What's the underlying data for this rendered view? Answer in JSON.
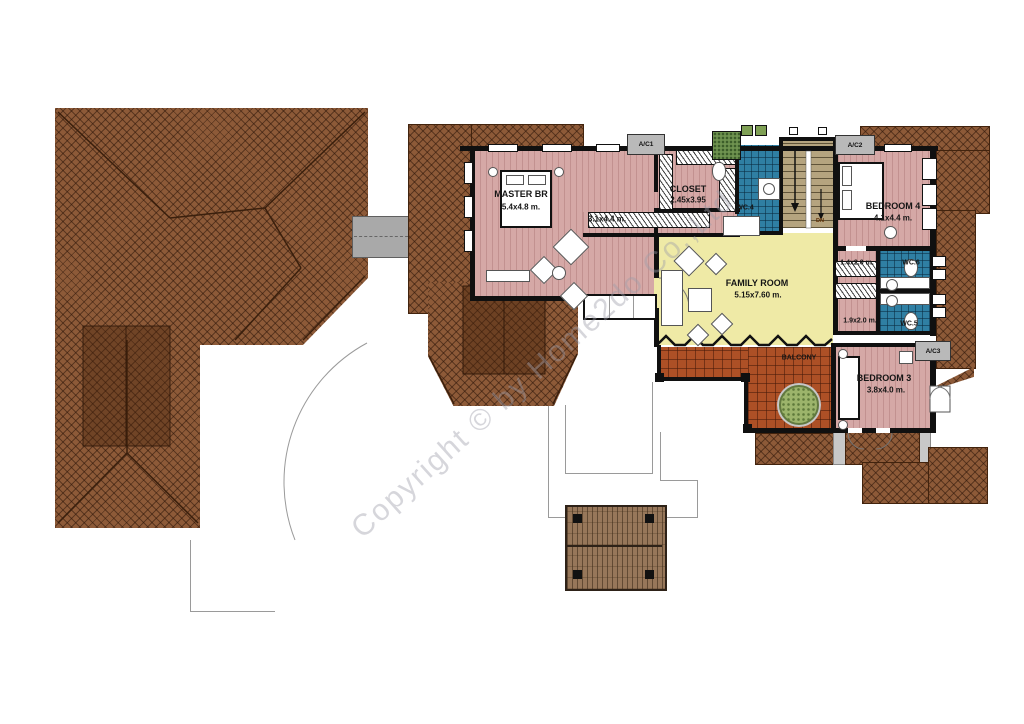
{
  "plan": {
    "type": "second-floor-plan",
    "watermark": "Copyright © by Home2do Co.,Ltd",
    "rooms": {
      "master": {
        "name": "MASTER BR",
        "dims": "5.4x4.8 m."
      },
      "sitting": {
        "dims": "3.1x4.4 m."
      },
      "closet": {
        "name": "CLOSET",
        "dims": "2.45x3.95"
      },
      "wc4": {
        "name": "WC.4"
      },
      "wc5": {
        "name": "WC.5"
      },
      "wc6": {
        "name": "WC.6"
      },
      "bedroom4": {
        "name": "BEDROOM 4",
        "dims": "4.1x4.4 m."
      },
      "bedroom3": {
        "name": "BEDROOM 3",
        "dims": "3.8x4.0 m."
      },
      "family": {
        "name": "FAMILY ROOM",
        "dims": "5.15x7.60 m."
      },
      "balcony": {
        "name": "BALCONY"
      },
      "dressing_top": {
        "dims": "1.4x2.0 m."
      },
      "dressing_bottom": {
        "dims": "1.9x2.0 m."
      }
    },
    "stairs": {
      "direction_label": "DN"
    },
    "equipment": {
      "ac1": "A/C1",
      "ac2": "A/C2",
      "ac3": "A/C3"
    },
    "colors": {
      "roof": "#8d5a38",
      "roof_dark": "#6f3f1d",
      "wall": "#101010",
      "bedroom_floor": "#d5a8a6",
      "family_floor": "#efeaa6",
      "wc_tile": "#2f7fa3",
      "stair": "#b5a47f",
      "balcony_tile": "#ad5026",
      "deck_wood": "#97775a",
      "bridge": "#a9a9a9",
      "planter": "#9cb46b",
      "canopy": "#c8c8c8",
      "ground_outline": "#9a9a9a",
      "watermark_gray": "#9ea0aa"
    }
  }
}
